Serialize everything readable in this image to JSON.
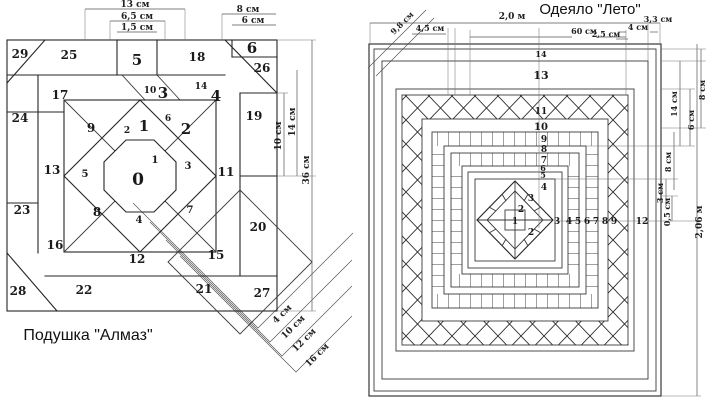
{
  "left": {
    "caption": "Подушка \"Алмаз\"",
    "pieces": {
      "p0": "0",
      "p1": "1",
      "p1s": "1",
      "p2": "2",
      "p2s": "2",
      "p3": "3",
      "p3s": "3",
      "p4": "4",
      "p4s": "4",
      "p5": "5",
      "p5s": "5",
      "p6": "6",
      "p6s": "6",
      "p7": "7",
      "p8": "8",
      "p9": "9",
      "p10": "10",
      "p11": "11",
      "p12": "12",
      "p13": "13",
      "p14": "14",
      "p15": "15",
      "p16": "16",
      "p17": "17",
      "p18": "18",
      "p19": "19",
      "p20": "20",
      "p21": "21",
      "p22": "22",
      "p23": "23",
      "p24": "24",
      "p25": "25",
      "p26": "26",
      "p27": "27",
      "p28": "28",
      "p29": "29"
    },
    "dims": {
      "top13": "13 см",
      "top65": "6,5 см",
      "top15": "1,5 см",
      "top8": "8 см",
      "top6": "6 см",
      "right10": "10 см",
      "right14": "14 см",
      "right36": "36 см",
      "diag4": "4 см",
      "diag10": "10 см",
      "diag12": "12 см",
      "diag16": "16 см"
    }
  },
  "right": {
    "title": "Одеяло \"Лето\"",
    "bands": {
      "b14": "14",
      "b13": "13",
      "b11": "11",
      "b10": "10",
      "b9": "9",
      "b8": "8",
      "b7": "7",
      "b6": "6",
      "b5": "5",
      "b4": "4",
      "b3": "3",
      "b2": "2",
      "b1": "1",
      "b2b": "2",
      "b3r": "3",
      "r4": "4",
      "r5": "5",
      "r6": "6",
      "r7": "7",
      "r8": "8",
      "r9": "9",
      "r12": "12"
    },
    "dims": {
      "d98": "9,8 см",
      "d20": "2,0 м",
      "d45": "4,5 см",
      "d60": "60 см",
      "d4": "4 см",
      "d25": "2,5 см",
      "d33": "3,3 см",
      "r8a": "8 см",
      "r14": "14 см",
      "r6": "6 см",
      "r8b": "8 см",
      "r3": "3 см",
      "r05": "0,5 см",
      "r206": "2,06 м"
    }
  }
}
